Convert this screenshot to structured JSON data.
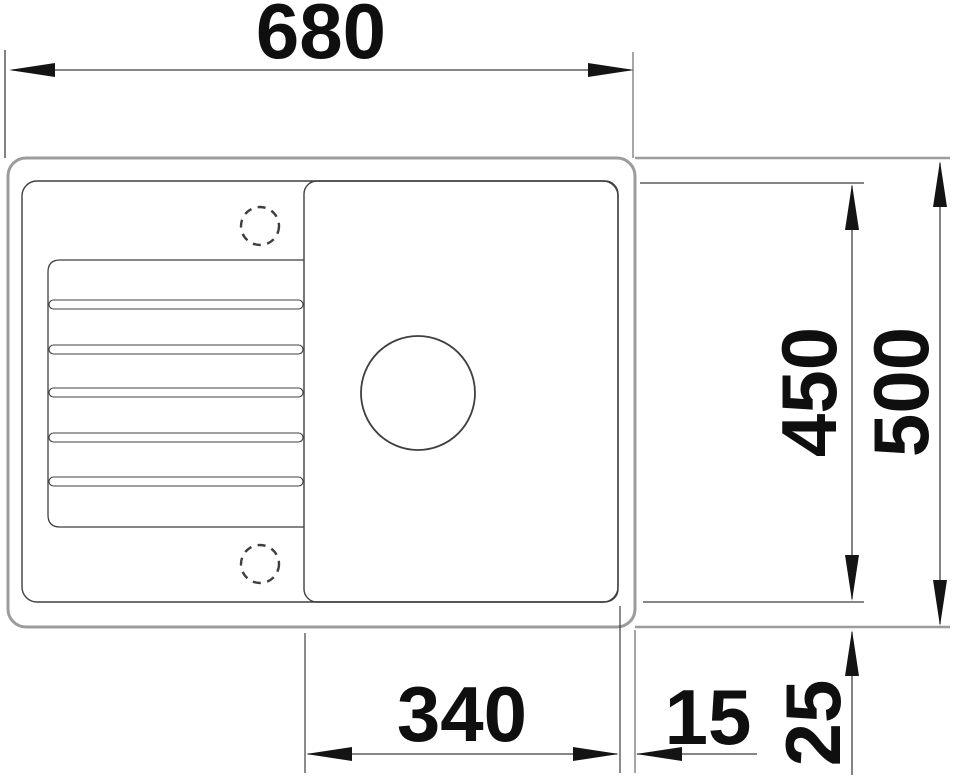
{
  "drawing": {
    "name": "sink-top-view-dimension-drawing",
    "view": "top",
    "subject": "inset kitchen sink with left drainboard, right bowl with drain hole, two tap holes",
    "labels": {
      "width_overall": "680",
      "depth_inner": "450",
      "depth_overall": "500",
      "bowl_width": "340",
      "bowl_to_edge_gap": "15",
      "rim_to_edge_gap": "25"
    },
    "colors": {
      "background": "#ffffff",
      "outer_contour": "#9c9c9c",
      "line": "#3f3f3f",
      "arrow": "#141414",
      "text": "#0f0f0f"
    }
  }
}
